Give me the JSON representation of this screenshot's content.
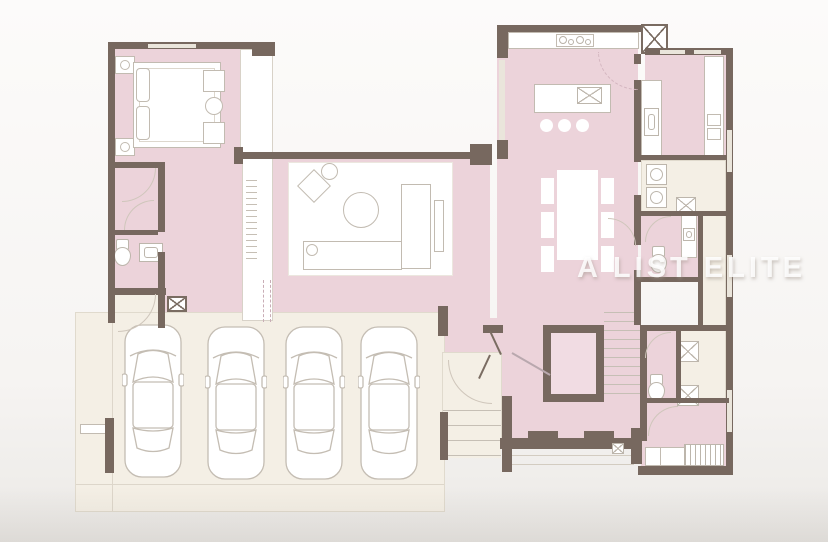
{
  "watermark": {
    "text": "A LIST ELITE"
  },
  "palette": {
    "room_fill": "#ecd3da",
    "stair_core_fill": "#f1dce3",
    "wall": "#77685f",
    "service_area_fill": "#f4efe5",
    "furniture_line": "#c2bbb1",
    "furniture_fill": "#ffffff",
    "background": "#f8f6f4"
  },
  "counts": {
    "garage_cars": 4,
    "kitchen_island_stools": 3,
    "dining_chairs": 6,
    "toilets": 3,
    "beds": 2
  }
}
